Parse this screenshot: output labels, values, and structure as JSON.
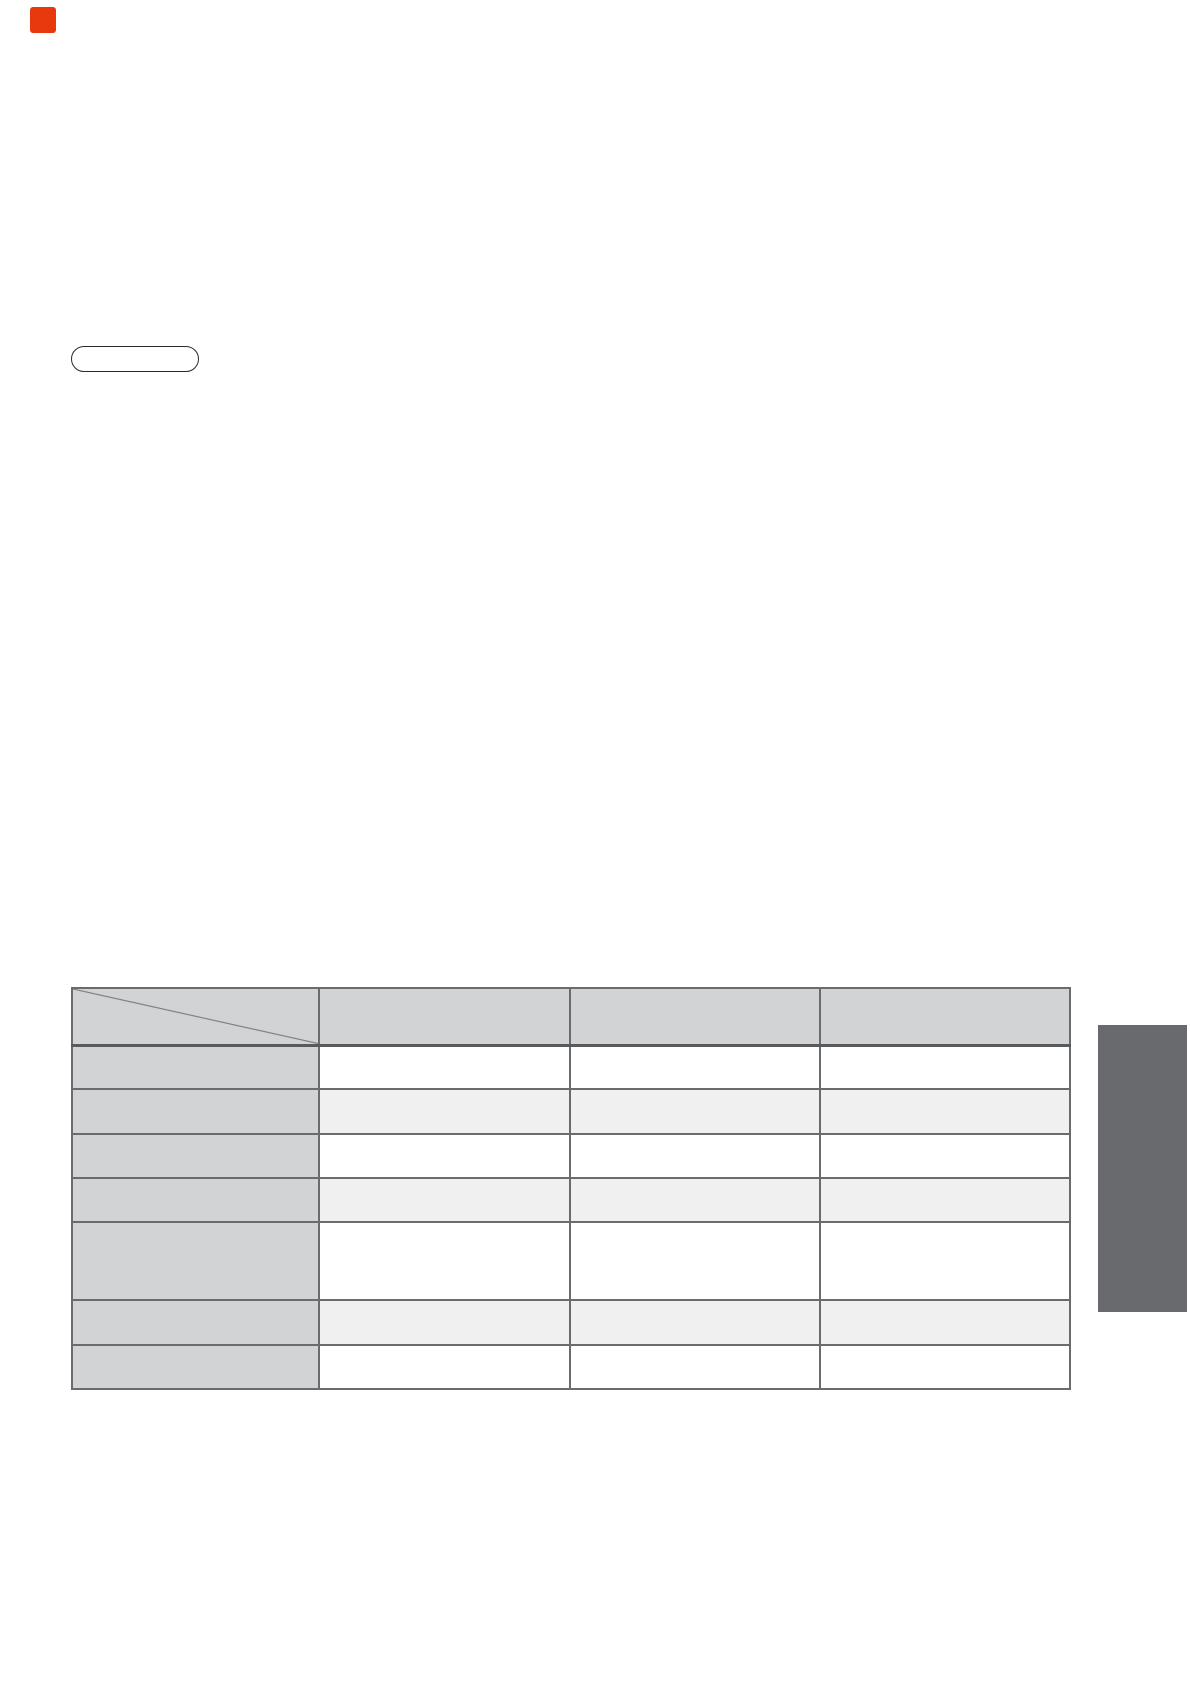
{
  "page": {
    "background": "#ffffff"
  },
  "red_marker": {
    "color": "#e8380d"
  },
  "pill_button": {
    "label": "",
    "border_color": "#2a2a2a"
  },
  "aspect_table": {
    "corner_label": "",
    "column_headers": [
      "",
      "",
      ""
    ],
    "rows": [
      {
        "label": "",
        "cells": [
          "",
          "",
          ""
        ]
      },
      {
        "label": "",
        "cells": [
          "",
          "",
          ""
        ]
      },
      {
        "label": "",
        "cells": [
          "",
          "",
          ""
        ]
      },
      {
        "label": "",
        "cells": [
          "",
          "",
          ""
        ]
      },
      {
        "label": "",
        "cells": [
          "",
          "",
          ""
        ]
      },
      {
        "label": "",
        "cells": [
          "",
          "",
          ""
        ]
      },
      {
        "label": "",
        "cells": [
          "",
          "",
          ""
        ]
      }
    ],
    "colors": {
      "header_bg": "#d1d3d4",
      "label_column_bg": "#d1d3d4",
      "row_bg": "#ffffff",
      "row_alt_bg": "#f0f0f1",
      "border": "#6a6b6e",
      "diagonal_line": "#808285"
    }
  },
  "side_tab": {
    "label": "",
    "color": "#696a6d"
  }
}
